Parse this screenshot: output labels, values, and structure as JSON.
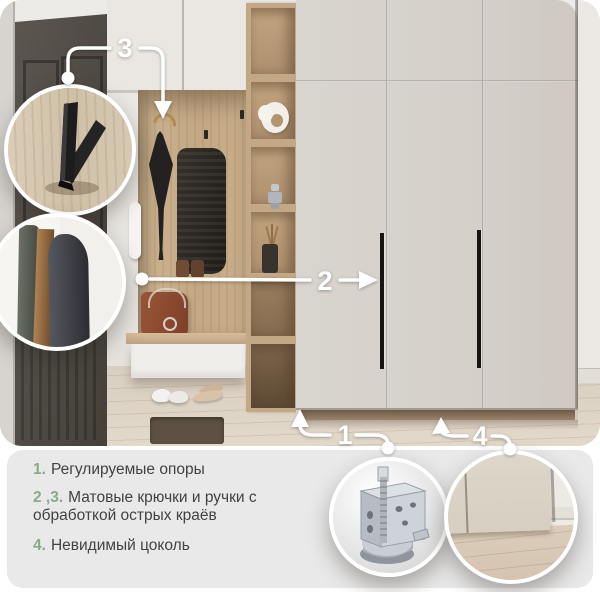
{
  "callouts": {
    "n1": "1",
    "n2": "2",
    "n3": "3",
    "n4": "4"
  },
  "features": [
    {
      "num": "1.",
      "text": "Регулируемые опоры"
    },
    {
      "num": "2 ,3.",
      "text": "Матовые крючки и ручки с обработкой острых краёв"
    },
    {
      "num": "4.",
      "text": "Невидимый цоколь"
    }
  ],
  "colors": {
    "accent_green": "#8CA88A",
    "card_bg": "#E9E9E9",
    "text": "#424242",
    "callout": "#FFFFFF"
  }
}
